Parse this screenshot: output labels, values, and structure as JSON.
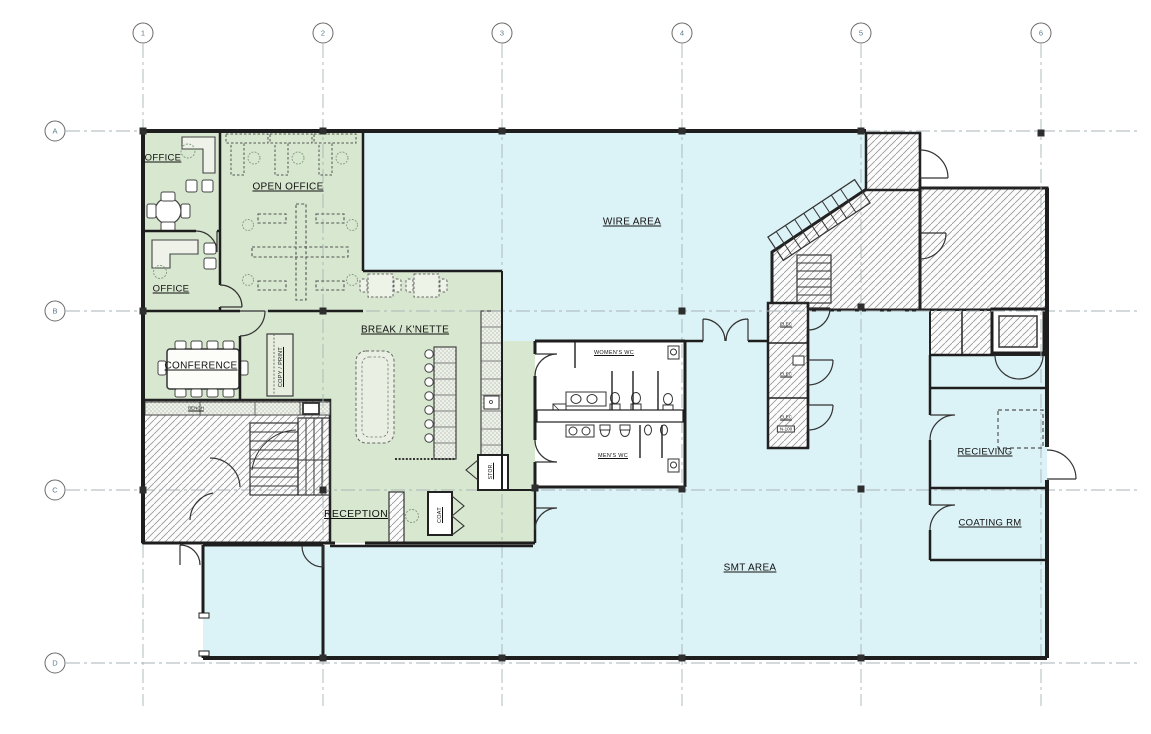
{
  "grid": {
    "columns": [
      "1",
      "2",
      "3",
      "4",
      "5",
      "6"
    ],
    "rows": [
      "A",
      "B",
      "C",
      "D"
    ]
  },
  "rooms": {
    "office_1": "OFFICE",
    "open_office": "OPEN OFFICE",
    "office_2": "OFFICE",
    "conference": "CONFERENCE",
    "copy_print": "COPY / PRINT",
    "break_kitchenette": "BREAK / K'NETTE",
    "reception": "RECEPTION",
    "coat": "COAT",
    "stor": "STOR.",
    "womens_wc": "WOMEN'S WC",
    "mens_wc": "MEN'S WC",
    "wire_area": "WIRE AREA",
    "smt_area": "SMT AREA",
    "recieving": "RECIEVING",
    "coating_rm": "COATING RM",
    "elec_1": "ELEC",
    "elec_2": "ELEC",
    "elec_3": "ELEC",
    "bench": "BENCH",
    "panel_tag": "N-100"
  },
  "colors": {
    "office_zone": "#d8e7cf",
    "production_zone": "#dbf2f6",
    "hatch_line": "#979797",
    "wall": "#1e1e1e",
    "gridline": "#a8b4b8"
  }
}
